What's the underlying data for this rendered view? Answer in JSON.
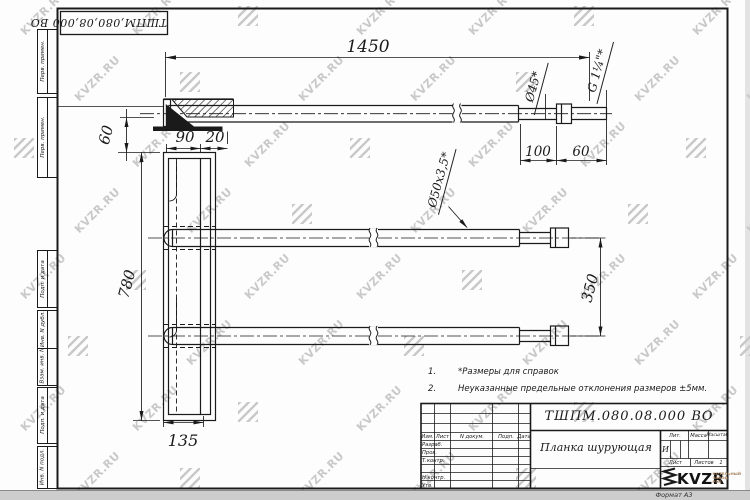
{
  "sheet": {
    "doc_number_top": "ТШПМ,080,08,000 ВО",
    "doc_number": "ТШПМ.080.08.000 ВО",
    "format_label": "Формат А3"
  },
  "watermark": {
    "text": "KVZR.RU"
  },
  "side_column": {
    "boxes": [
      "Перв. примен.",
      "Перв. примен.",
      "Подп. и дата",
      "Инв. N дубл.",
      "Взам. инв. N",
      "Подп. и дата",
      "Инв. N подл."
    ]
  },
  "notes": [
    {
      "num": "1.",
      "text": "*Размеры для справок"
    },
    {
      "num": "2.",
      "text": "Неуказанные предельные отклонения размеров ±5мм."
    }
  ],
  "dimensions": {
    "top_length": "1450",
    "hook_height": "60",
    "plate_top_width": "90",
    "plate_lip": "20",
    "plate_height": "780",
    "plate_bottom_width": "135",
    "end_neck_length": "100",
    "end_fitting_length": "60",
    "tube_spacing": "350",
    "end_diameter": "Ø45*",
    "thread_label": "G 1¼\"*",
    "tube_section": "Ø50x3,5*"
  },
  "title_block": {
    "header_cells": [
      "Изм.",
      "Лист",
      "N докум.",
      "Подп.",
      "Дата"
    ],
    "approval_rows": [
      "Разраб.",
      "Пров.",
      "Т.контр.",
      "",
      "Н.контр.",
      "Утв."
    ],
    "part_name": "Планка шурующая",
    "lit_label": "Лит.",
    "lit_value": "И",
    "mass_label": "Масса",
    "scale_label": "Масштаб",
    "sheet_label": "Лист",
    "sheets_label": "Листов",
    "sheets_value": "1",
    "logo_text": "KVZR",
    "logo_sub": "КОТЕЛЬНЫЙ ЗАВОД РЭП"
  }
}
